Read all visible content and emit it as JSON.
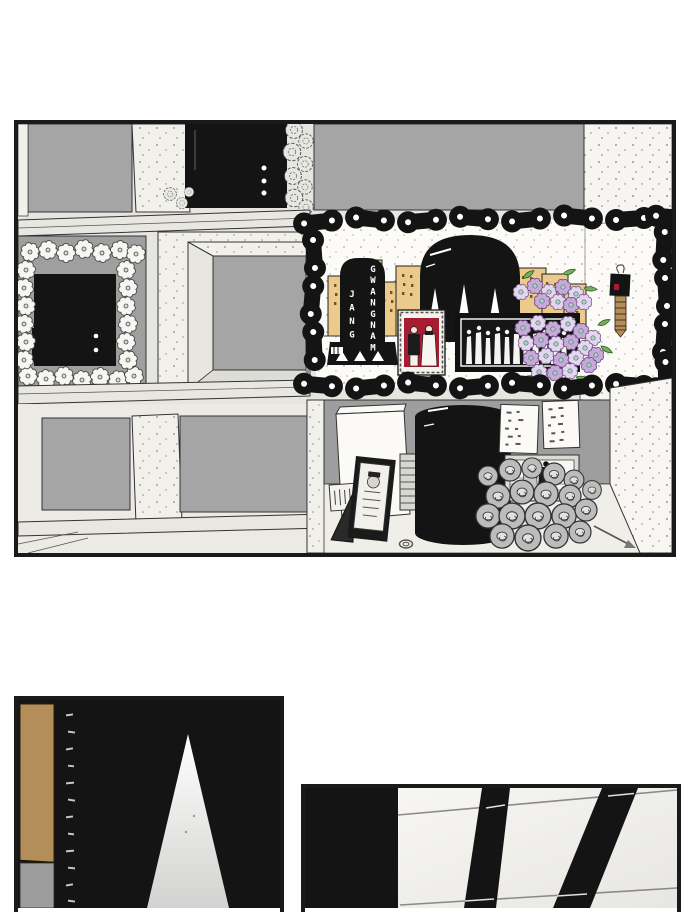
{
  "page": {
    "kind": "comic-page",
    "background": "#ffffff"
  },
  "panels": [
    {
      "id": "main",
      "name": "columbarium-memorial-wall-panel"
    },
    {
      "id": "bottom_left",
      "name": "dark-room-wood-post-panel"
    },
    {
      "id": "bottom_right",
      "name": "overhead-beams-panel"
    }
  ],
  "memorial": {
    "plaque_left_column": "JANG",
    "plaque_right_column": "GWANGNAM",
    "full_name": "JANG GWANGNAM"
  },
  "colors": {
    "ink": "#141414",
    "paper": "#ffffff",
    "wall_light": "#f2f0ea",
    "wall_mid": "#e7e5df",
    "beam": "#e9e7e1",
    "niche_gray": "#a5a5a5",
    "back_gray": "#9e9e9e",
    "skyline_tan": "#ecca8c",
    "window_brown": "#6b5526",
    "flower_purple": "#c7a9da",
    "flower_purple_light": "#e4d6ee",
    "flower_teal": "#abd2c3",
    "leaf_green": "#74b05c",
    "photo_red": "#a81c33",
    "wood_tan": "#b38e58",
    "strip_gray": "#9d9d9d",
    "donut_gray": "#bcbcbc"
  }
}
